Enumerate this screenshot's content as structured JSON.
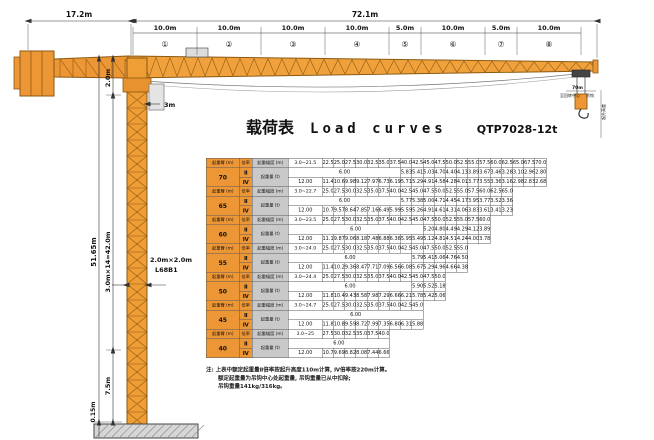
{
  "title": {
    "zh": "载荷表",
    "en": "Load  curves",
    "model": "QTP7028-12t"
  },
  "dimensions": {
    "counter_jib": "17.2m",
    "jib_total": "72.1m",
    "segments": [
      {
        "label": "10.0m",
        "mark": "①"
      },
      {
        "label": "10.0m",
        "mark": "②"
      },
      {
        "label": "10.0m",
        "mark": "③"
      },
      {
        "label": "10.0m",
        "mark": "④"
      },
      {
        "label": "5.0m",
        "mark": "⑤"
      },
      {
        "label": "10.0m",
        "mark": "⑥"
      },
      {
        "label": "5.0m",
        "mark": "⑦"
      },
      {
        "label": "10.0m",
        "mark": "⑧"
      }
    ],
    "top_section": "2.0m",
    "head_width": "3m",
    "tower_total": "51.65m",
    "standard_sections": "3.0m×14=42.0m",
    "mast_size": "2.0m×2.0m",
    "mast_type": "L68B1",
    "base_section": "7.5m",
    "foundation": "0.15m",
    "hook_radius": "70m",
    "hook_center": "至回转中心",
    "hook_box": "吊钩",
    "lift_height": "起升高度"
  },
  "table": {
    "headers": {
      "jib": "起重臂 (m)",
      "rate": "倍率",
      "radius": "起重幅度 (m)",
      "load": "起重量 (t)",
      "rate2": "Ⅱ",
      "rate4": "Ⅳ"
    },
    "max2": "6.00",
    "max4": "12.00",
    "groups": [
      {
        "jib": "70",
        "range": "3.0~21.5",
        "radii": [
          "22.5",
          "25.0",
          "27.5",
          "30.0",
          "32.5",
          "35.0",
          "37.5",
          "40.0",
          "42.5",
          "45.0",
          "47.5",
          "50.0",
          "52.5",
          "55.0",
          "57.5",
          "60.0",
          "62.5",
          "65.0",
          "67.5",
          "70.0"
        ],
        "r2_span": 8,
        "r2": [
          "5.83",
          "5.41",
          "5.03",
          "4.70",
          "4.40",
          "4.13",
          "3.89",
          "3.67",
          "3.46",
          "3.28",
          "3.10",
          "2.96",
          "2.80"
        ],
        "r4": [
          "11.40",
          "10.68",
          "9.98",
          "9.12",
          "7.97",
          "6.73",
          "6.19",
          "5.71",
          "5.29",
          "4.91",
          "4.58",
          "4.28",
          "4.01",
          "3.77",
          "3.55",
          "3.36",
          "3.16",
          "2.98",
          "2.83",
          "2.68"
        ]
      },
      {
        "jib": "65",
        "range": "3.0~22.7",
        "radii": [
          "25.0",
          "27.5",
          "30.0",
          "32.5",
          "35.0",
          "37.5",
          "40.0",
          "42.5",
          "45.0",
          "47.5",
          "50.0",
          "52.5",
          "55.0",
          "57.5",
          "60.0",
          "62.5",
          "65.0"
        ],
        "r2_span": 8,
        "r2": [
          "5.77",
          "5.38",
          "5.00",
          "4.71",
          "4.45",
          "4.17",
          "3.95",
          "3.77",
          "3.52",
          "3.36"
        ],
        "r4": [
          "10.71",
          "9.57",
          "8.64",
          "7.85",
          "7.16",
          "6.49",
          "5.99",
          "5.59",
          "5.26",
          "4.91",
          "4.61",
          "4.31",
          "4.06",
          "3.83",
          "3.61",
          "3.41",
          "3.23"
        ]
      },
      {
        "jib": "60",
        "range": "3.0~23.5",
        "radii": [
          "25.0",
          "27.5",
          "30.0",
          "32.5",
          "35.0",
          "37.5",
          "40.0",
          "42.5",
          "45.0",
          "47.5",
          "50.0",
          "52.5",
          "55.0",
          "57.5",
          "60.0"
        ],
        "r2_span": 10,
        "r2": [
          "5.20",
          "4.80",
          "4.49",
          "4.29",
          "4.12",
          "3.89"
        ],
        "r4": [
          "11.15",
          "9.87",
          "9.06",
          "8.18",
          "7.48",
          "6.88",
          "6.36",
          "5.95",
          "5.49",
          "5.12",
          "4.81",
          "4.51",
          "4.24",
          "4.00",
          "3.78"
        ]
      },
      {
        "jib": "55",
        "range": "3.0~24.0",
        "radii": [
          "25.0",
          "27.5",
          "30.0",
          "32.5",
          "35.0",
          "37.5",
          "40.0",
          "42.5",
          "45.0",
          "47.5",
          "50.0",
          "52.5",
          "55.0"
        ],
        "r2_span": 9,
        "r2": [
          "5.79",
          "5.41",
          "5.06",
          "4.76",
          "4.50"
        ],
        "r4": [
          "11.48",
          "10.25",
          "9.36",
          "8.47",
          "7.71",
          "7.09",
          "6.56",
          "6.08",
          "5.67",
          "5.29",
          "4.96",
          "4.66",
          "4.38"
        ]
      },
      {
        "jib": "50",
        "range": "3.0~24.4",
        "radii": [
          "25.0",
          "27.5",
          "30.0",
          "32.5",
          "35.0",
          "37.5",
          "40.0",
          "42.5",
          "45.0",
          "47.5",
          "50.0"
        ],
        "r2_span": 9,
        "r2": [
          "5.90",
          "5.52",
          "5.18"
        ],
        "r4": [
          "11.87",
          "10.44",
          "9.43",
          "8.58",
          "7.98",
          "7.29",
          "6.66",
          "6.21",
          "5.78",
          "5.42",
          "5.06"
        ]
      },
      {
        "jib": "45",
        "range": "3.0~24.7",
        "radii": [
          "25.0",
          "27.5",
          "30.0",
          "32.5",
          "35.0",
          "37.5",
          "40.0",
          "42.5",
          "45.0"
        ],
        "r2_span": 10,
        "r2": [],
        "r4": [
          "11.88",
          "10.82",
          "9.59",
          "8.72",
          "7.99",
          "7.35",
          "6.80",
          "6.31",
          "5.88"
        ]
      },
      {
        "jib": "40",
        "range": "3.0~25",
        "radii": [
          "27.5",
          "30.0",
          "32.5",
          "35.0",
          "37.5",
          "40.0"
        ],
        "r2_span": 7,
        "r2": [],
        "r4": [
          "10.73",
          "9.69",
          "8.82",
          "8.08",
          "7.44",
          "6.66"
        ]
      }
    ]
  },
  "notes": [
    "注: 上表中额定起重量Ⅱ倍率按起升高度110m计算, Ⅳ倍率按220m计算。",
    "额定起重量为吊钩中心处起重量, 吊钩重量已从中扣除;",
    "吊钩重量141kg/316kg。"
  ],
  "colors": {
    "crane_orange": "#ED9636",
    "crane_outline": "#8B5A12",
    "cell_gray": "#C9C9C9",
    "dim_line": "#333333"
  }
}
